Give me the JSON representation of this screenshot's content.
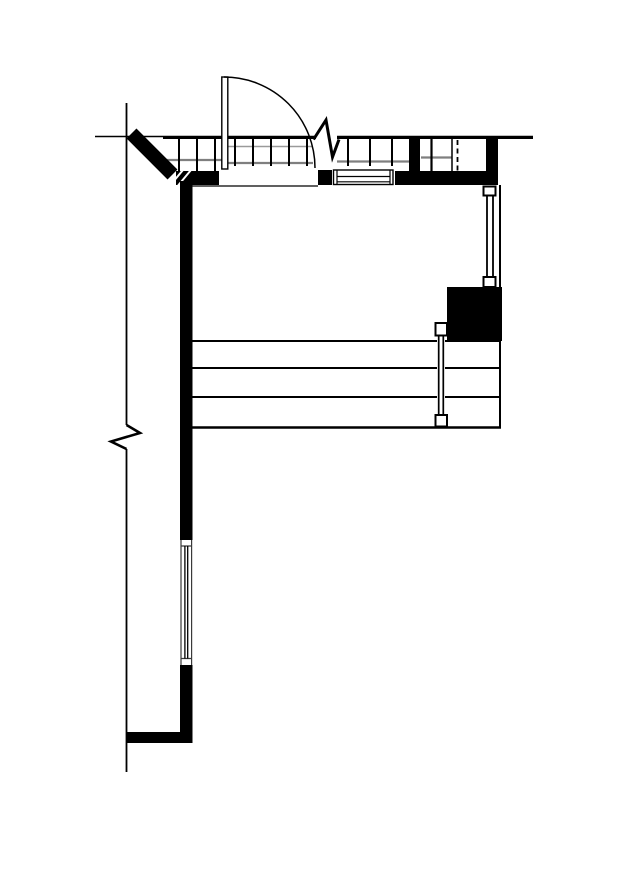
{
  "drawing": {
    "kind": "architectural-floor-plan-fragment",
    "text_labels": [],
    "colors": {
      "paper": "#ffffff",
      "ink": "#000000",
      "hatch_gray": "#7f7f7f",
      "hatch_gray_light": "#9a9a9a",
      "window_frame_gray": "#3a3a3a"
    },
    "components": [
      "top-reference-line",
      "left-reference-line",
      "left-reference-break-mark",
      "top-wall-face-line",
      "top-wall-break-mark",
      "glazing-hatch-strip",
      "hatch-cell-box",
      "dashed-partition-line",
      "top-wall-solid-segments",
      "top-window-sill",
      "door-threshold-line",
      "diagonal-corner-wall",
      "masonry-joint-slashes",
      "left-wall",
      "left-wall-window",
      "bottom-wall-return",
      "floor-step-lines",
      "right-boundary-line",
      "right-glazing-upper",
      "right-glazing-lower",
      "solid-column",
      "entry-door-leaf",
      "entry-door-swing-arc"
    ]
  }
}
